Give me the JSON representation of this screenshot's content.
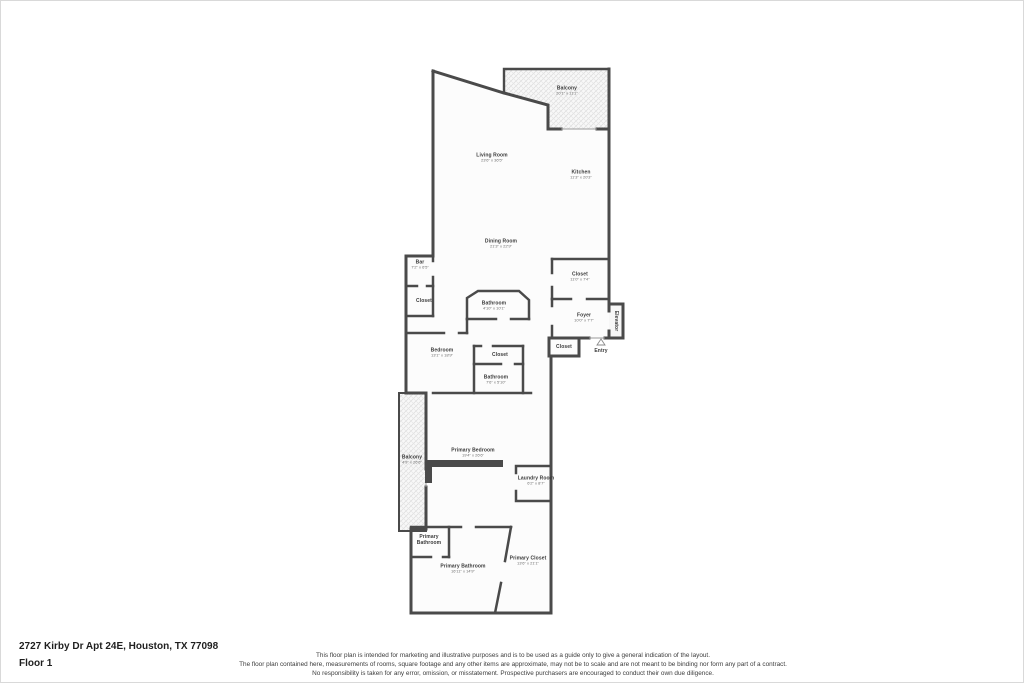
{
  "plan": {
    "wall_color": "#4a4a4a",
    "room_fill": "#fcfcfc",
    "hatch_color": "#dcdcdc",
    "labels": [
      {
        "id": "balcony-upper",
        "name": "Balcony",
        "dims": "20'1\" x 11'1\"",
        "x": 566,
        "y": 90
      },
      {
        "id": "living-room",
        "name": "Living Room",
        "dims": "23'6\" x 36'5\"",
        "x": 491,
        "y": 157
      },
      {
        "id": "kitchen",
        "name": "Kitchen",
        "dims": "11'3\" x 20'3\"",
        "x": 580,
        "y": 174
      },
      {
        "id": "dining-room",
        "name": "Dining Room",
        "dims": "21'3\" x 22'9\"",
        "x": 500,
        "y": 243
      },
      {
        "id": "bar",
        "name": "Bar",
        "dims": "7'2\" x 6'5\"",
        "x": 419,
        "y": 264
      },
      {
        "id": "closet-bar",
        "name": "Closet",
        "dims": "",
        "x": 423,
        "y": 300
      },
      {
        "id": "bathroom-upper",
        "name": "Bathroom",
        "dims": "4'10\" x 10'1\"",
        "x": 493,
        "y": 305
      },
      {
        "id": "closet-right",
        "name": "Closet",
        "dims": "11'0\" x 7'4\"",
        "x": 579,
        "y": 276
      },
      {
        "id": "foyer",
        "name": "Foyer",
        "dims": "10'0\" x 7'7\"",
        "x": 583,
        "y": 317
      },
      {
        "id": "elevator",
        "name": "Elevator",
        "dims": "",
        "x": 615,
        "y": 320,
        "vertical": true
      },
      {
        "id": "bedroom",
        "name": "Bedroom",
        "dims": "13'1\" x 18'9\"",
        "x": 441,
        "y": 352
      },
      {
        "id": "closet-middle",
        "name": "Closet",
        "dims": "",
        "x": 499,
        "y": 354
      },
      {
        "id": "closet-entry",
        "name": "Closet",
        "dims": "",
        "x": 563,
        "y": 346
      },
      {
        "id": "entry",
        "name": "Entry",
        "dims": "",
        "x": 600,
        "y": 350
      },
      {
        "id": "bathroom-middle",
        "name": "Bathroom",
        "dims": "7'6\" x 5'10\"",
        "x": 495,
        "y": 379
      },
      {
        "id": "balcony-lower",
        "name": "Balcony",
        "dims": "4'9\" x 26'6\"",
        "x": 411,
        "y": 459
      },
      {
        "id": "primary-bedroom",
        "name": "Primary Bedroom",
        "dims": "19'4\" x 26'6\"",
        "x": 472,
        "y": 452
      },
      {
        "id": "laundry-room",
        "name": "Laundry Room",
        "dims": "6'2\" x 8'7\"",
        "x": 535,
        "y": 480
      },
      {
        "id": "primary-bathroom-small",
        "name": "Primary Bathroom",
        "dims": "",
        "x": 428,
        "y": 539,
        "wrap": true
      },
      {
        "id": "primary-bathroom",
        "name": "Primary Bathroom",
        "dims": "16'11\" x 14'9\"",
        "x": 462,
        "y": 568
      },
      {
        "id": "primary-closet",
        "name": "Primary Closet",
        "dims": "13'6\" x 21'1\"",
        "x": 527,
        "y": 560
      }
    ]
  },
  "footer": {
    "address": "2727 Kirby Dr Apt 24E, Houston, TX 77098",
    "floor": "Floor 1",
    "disclaimer_lines": [
      "This floor plan is intended for marketing and illustrative purposes and is to be used as a guide only to give a general indication of the layout.",
      "The floor plan contained here, measurements of rooms, square footage and any other items are approximate, may not be to scale and are not meant to be binding nor form any part of a contract.",
      "No responsibility is taken for any error, omission, or misstatement. Prospective purchasers are encouraged to conduct their own due diligence."
    ]
  }
}
